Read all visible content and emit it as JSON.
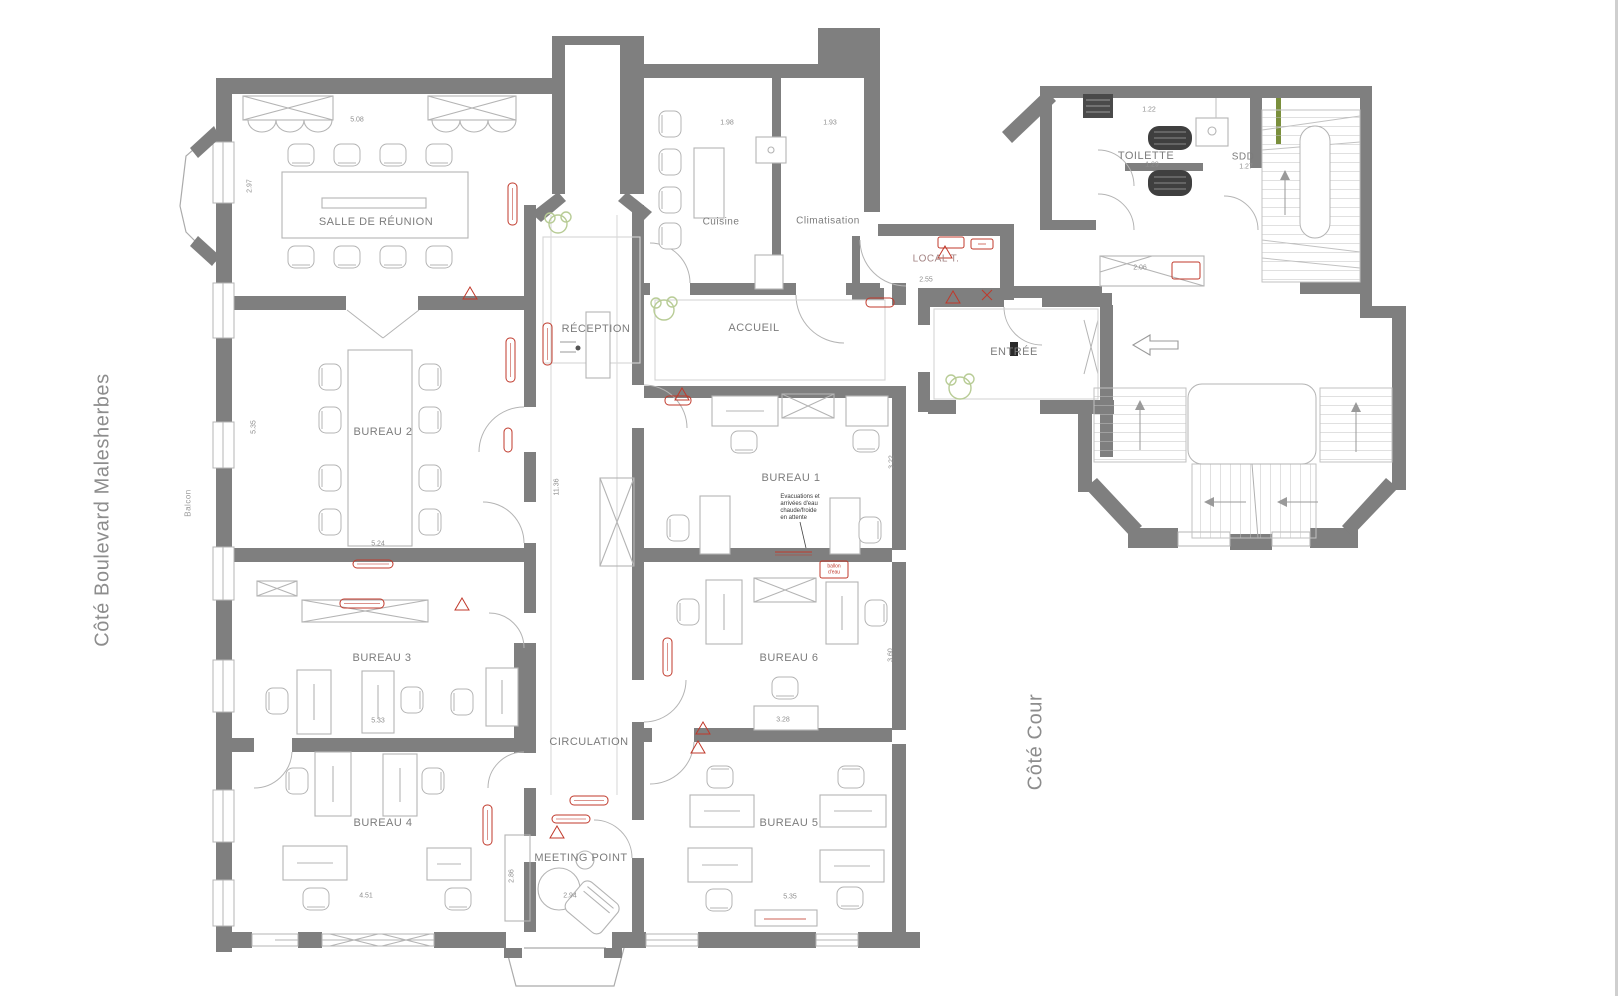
{
  "plan": {
    "side_label_left": "Côté Boulevard Malesherbes",
    "side_label_right": "Côté Cour",
    "balcony_label": "Balcon"
  },
  "rooms": {
    "salle_de_reunion": "SALLE DE RÉUNION",
    "bureau_1": "BUREAU 1",
    "bureau_2": "BUREAU 2",
    "bureau_3": "BUREAU 3",
    "bureau_4": "BUREAU 4",
    "bureau_5": "BUREAU 5",
    "bureau_6": "BUREAU 6",
    "reception": "RÉCEPTION",
    "circulation": "CIRCULATION",
    "meeting_point": "MEETING POINT",
    "accueil": "ACCUEIL",
    "cuisine": "Cuisine",
    "climatisation": "Climatisation",
    "local_t": "LOCAL T.",
    "entree": "ENTRÉE",
    "toilette": "TOILETTE",
    "sdd": "SDD"
  },
  "annotations": {
    "bureau1_note": "Evacuations et\narrivées d'eau\nchaude/froide\nen attente",
    "ballon_eau": "ballon\nd'eau"
  },
  "colors": {
    "wall": "#7f7f7f",
    "furniture": "#b4b4b4",
    "annotation_red": "#c0392b",
    "plant_green": "#b8cc96",
    "fixture_dark": "#474747"
  },
  "dimensions": [
    {
      "v": "5.08",
      "x": 357,
      "y": 120,
      "r": 0
    },
    {
      "v": "2.97",
      "x": 250,
      "y": 186,
      "r": -90
    },
    {
      "v": "1.98",
      "x": 727,
      "y": 123,
      "r": 0
    },
    {
      "v": "1.93",
      "x": 830,
      "y": 123,
      "r": 0
    },
    {
      "v": "5.35",
      "x": 254,
      "y": 427,
      "r": -90
    },
    {
      "v": "5.24",
      "x": 378,
      "y": 544,
      "r": 0
    },
    {
      "v": "5.33",
      "x": 378,
      "y": 721,
      "r": 0
    },
    {
      "v": "4.51",
      "x": 366,
      "y": 896,
      "r": 0
    },
    {
      "v": "2.94",
      "x": 570,
      "y": 896,
      "r": 0
    },
    {
      "v": "2.86",
      "x": 512,
      "y": 876,
      "r": -90
    },
    {
      "v": "11.36",
      "x": 557,
      "y": 487,
      "r": -90
    },
    {
      "v": "5.35",
      "x": 790,
      "y": 897,
      "r": 0
    },
    {
      "v": "3.28",
      "x": 783,
      "y": 720,
      "r": 0
    },
    {
      "v": "3.60",
      "x": 891,
      "y": 655,
      "r": -90
    },
    {
      "v": "3.22",
      "x": 892,
      "y": 462,
      "r": -90
    },
    {
      "v": "2.55",
      "x": 926,
      "y": 280,
      "r": 0
    },
    {
      "v": "2.06",
      "x": 1140,
      "y": 268,
      "r": 0
    },
    {
      "v": "1.22",
      "x": 1149,
      "y": 110,
      "r": 0
    },
    {
      "v": "1.29",
      "x": 1152,
      "y": 165,
      "r": 0
    },
    {
      "v": "1.27",
      "x": 1246,
      "y": 167,
      "r": 0
    }
  ]
}
